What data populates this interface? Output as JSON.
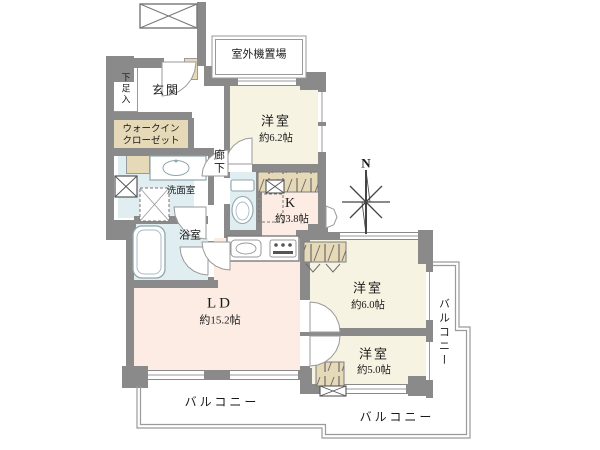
{
  "floorplan": {
    "compass": {
      "north_label": "N"
    },
    "rooms": {
      "genkan": {
        "label": "玄関"
      },
      "shoe_cabinet": {
        "label": "下足入"
      },
      "walk_in_closet": {
        "line1": "ウォークイン",
        "line2": "クローゼット"
      },
      "hallway": {
        "label": "廊下"
      },
      "washroom": {
        "label": "洗面室"
      },
      "bathroom": {
        "label": "浴室"
      },
      "outdoor_unit_space": {
        "label": "室外機置場"
      },
      "bedroom_62": {
        "label": "洋室",
        "size": "約6.2帖"
      },
      "kitchen": {
        "label": "K",
        "size": "約3.8帖"
      },
      "living_dining": {
        "label": "LD",
        "size": "約15.2帖"
      },
      "bedroom_60": {
        "label": "洋室",
        "size": "約6.0帖"
      },
      "bedroom_50": {
        "label": "洋室",
        "size": "約5.0帖"
      }
    },
    "balconies": {
      "right": {
        "label": "バルコニー"
      },
      "bottom_left": {
        "label": "バルコニー"
      },
      "bottom_right": {
        "label": "バルコニー"
      }
    },
    "colors": {
      "wall": "#8a8a8a",
      "bedroom_fill": "#f7f3e2",
      "living_kitchen_fill": "#fcece3",
      "closet_fill": "#e6d9b8",
      "wet_area_fill": "#e0eef1",
      "balcony_line": "#9a9a9a",
      "text": "#1a1a1a"
    }
  }
}
